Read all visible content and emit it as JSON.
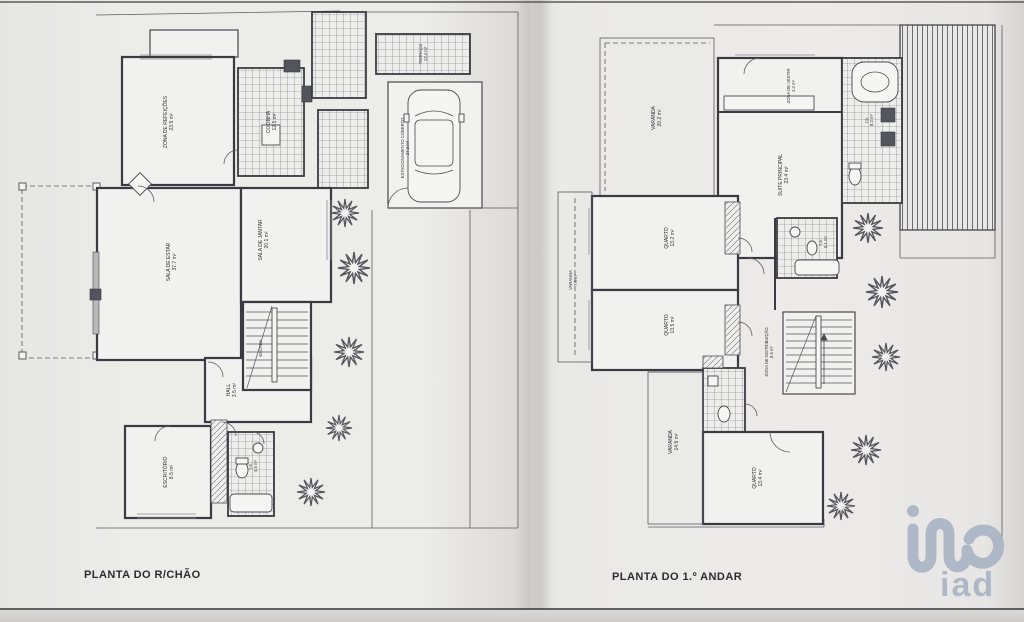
{
  "plans": {
    "ground": {
      "title": "PLANTA DO R/CHÃO",
      "rooms": {
        "refeicoes": {
          "label": "ZONA DE REFEIÇÕES",
          "area": "23.5 m²"
        },
        "cozinha": {
          "label": "COZINHA",
          "area": "12.1 m²"
        },
        "sala_estar": {
          "label": "SALA DE ESTAR",
          "area": "37.7 m²"
        },
        "sala_jantar": {
          "label": "SALA DE JANTAR",
          "area": "20.1 m²"
        },
        "hall": {
          "label": "HALL",
          "area": "3.5 m²"
        },
        "escritorio": {
          "label": "ESCRITÓRIO",
          "area": "8.5 m²"
        },
        "is": {
          "label": "I.S.",
          "area": "4.5 m²"
        },
        "estacionamento": {
          "label": "ESTACIONAMENTO COBERTO",
          "area": "27.3 m²"
        },
        "terraco": {
          "label": "TERRAÇO",
          "area": "12.4 m²"
        },
        "escada": {
          "label": "ESCADA",
          "area": ""
        }
      }
    },
    "first": {
      "title": "PLANTA DO 1.º ANDAR",
      "rooms": {
        "varanda_top": {
          "label": "VARANDA",
          "area": "20.2 m²"
        },
        "zona_vestir": {
          "label": "ZONA DE VESTIR",
          "area": "4.2 m²"
        },
        "suite": {
          "label": "SUITE PRINCIPAL",
          "area": "23.4 m²"
        },
        "is_suite": {
          "label": "I.S.",
          "area": "8.2 m²"
        },
        "quarto1": {
          "label": "QUARTO",
          "area": "13.2 m²"
        },
        "quarto2": {
          "label": "QUARTO",
          "area": "13.5 m²"
        },
        "is2": {
          "label": "I.S.",
          "area": "5.1 m²"
        },
        "distribuicao": {
          "label": "ZONA DE DISTRIBUIÇÃO",
          "area": "8.6 m²"
        },
        "varanda_left": {
          "label": "VARANDA",
          "area": "7.5 m²"
        },
        "varanda_bottom": {
          "label": "VARANDA",
          "area": "14.9 m²"
        },
        "quarto3": {
          "label": "QUARTO",
          "area": "13.4 m²"
        }
      }
    }
  },
  "watermark": {
    "text": "iad"
  },
  "colors": {
    "ink": "#3a3a42",
    "paper": "#e8e8e6",
    "watermark": "#a9b3c3"
  }
}
